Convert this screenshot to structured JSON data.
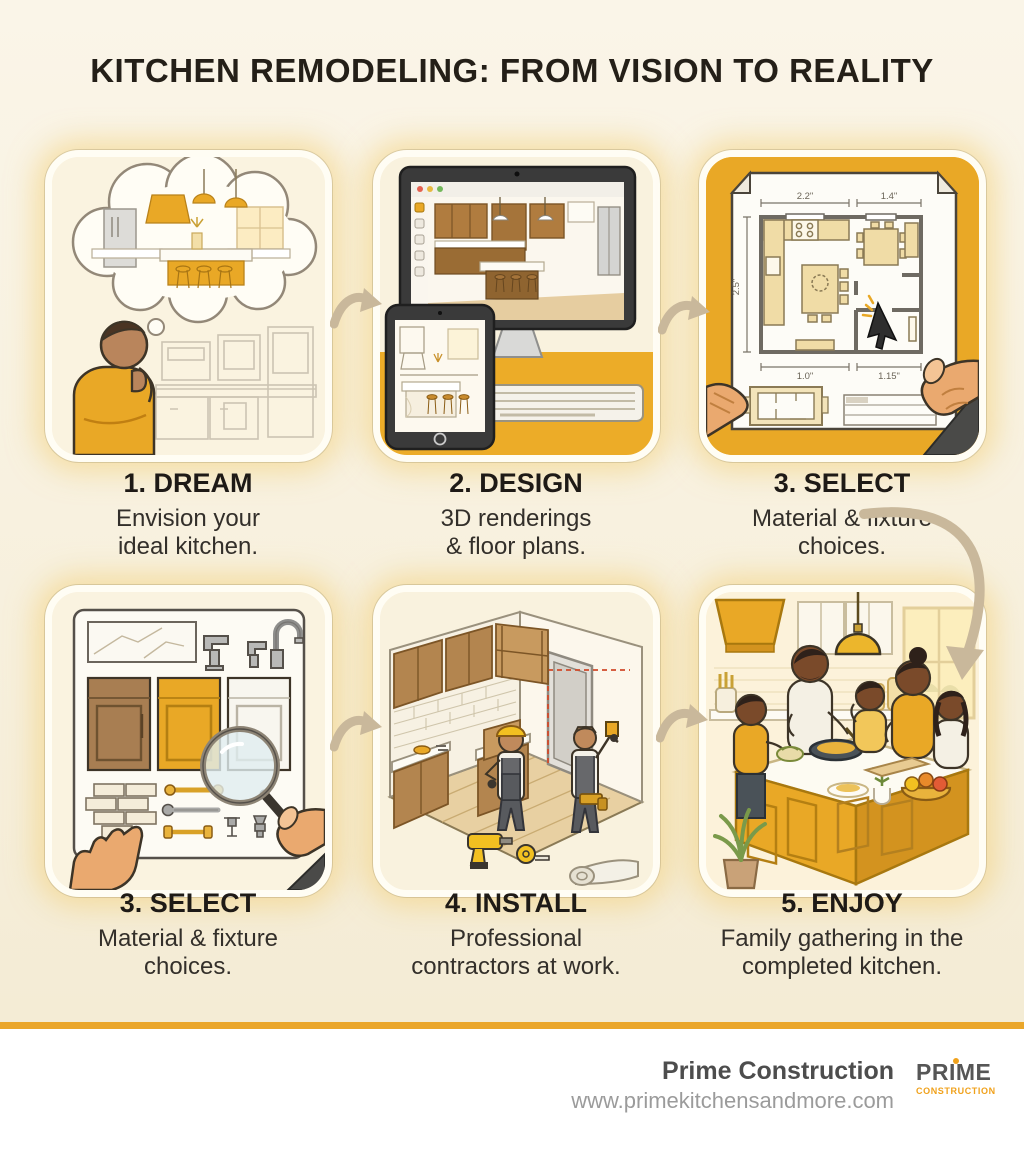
{
  "title": "KITCHEN REMODELING: FROM VISION TO REALITY",
  "steps": [
    {
      "heading": "1. DREAM",
      "line1": "Envision your",
      "line2": "ideal kitchen."
    },
    {
      "heading": "2. DESIGN",
      "line1": "3D renderings",
      "line2": "& floor plans."
    },
    {
      "heading": "3. SELECT",
      "line1": "Material & fixture",
      "line2": "choices."
    },
    {
      "heading": "3. SELECT",
      "line1": "Material & fixture",
      "line2": "choices."
    },
    {
      "heading": "4. INSTALL",
      "line1": "Professional",
      "line2": "contractors at work."
    },
    {
      "heading": "5. ENJOY",
      "line1": "Family gathering in the",
      "line2": "completed kitchen."
    }
  ],
  "floorplan_dimensions": {
    "top_left": "2.2\"",
    "top_right": "1.4\"",
    "left_side": "2.5\"",
    "bottom_left": "1.0\"",
    "bottom_right": "1.15\""
  },
  "footer": {
    "company": "Prime Construction",
    "website": "www.primekitchensandmore.com",
    "logo_line1": "PRIME",
    "logo_line2": "CONSTRUCTION"
  },
  "palette": {
    "accent_gold": "#E9A826",
    "divider_gold": "#EAA62A",
    "background_cream": "#f7f0dd",
    "arrow_tan": "#c9b89b",
    "glow_yellow": "#f3cd73",
    "text_dark": "#241f18",
    "laser_red": "#d04a2a"
  }
}
